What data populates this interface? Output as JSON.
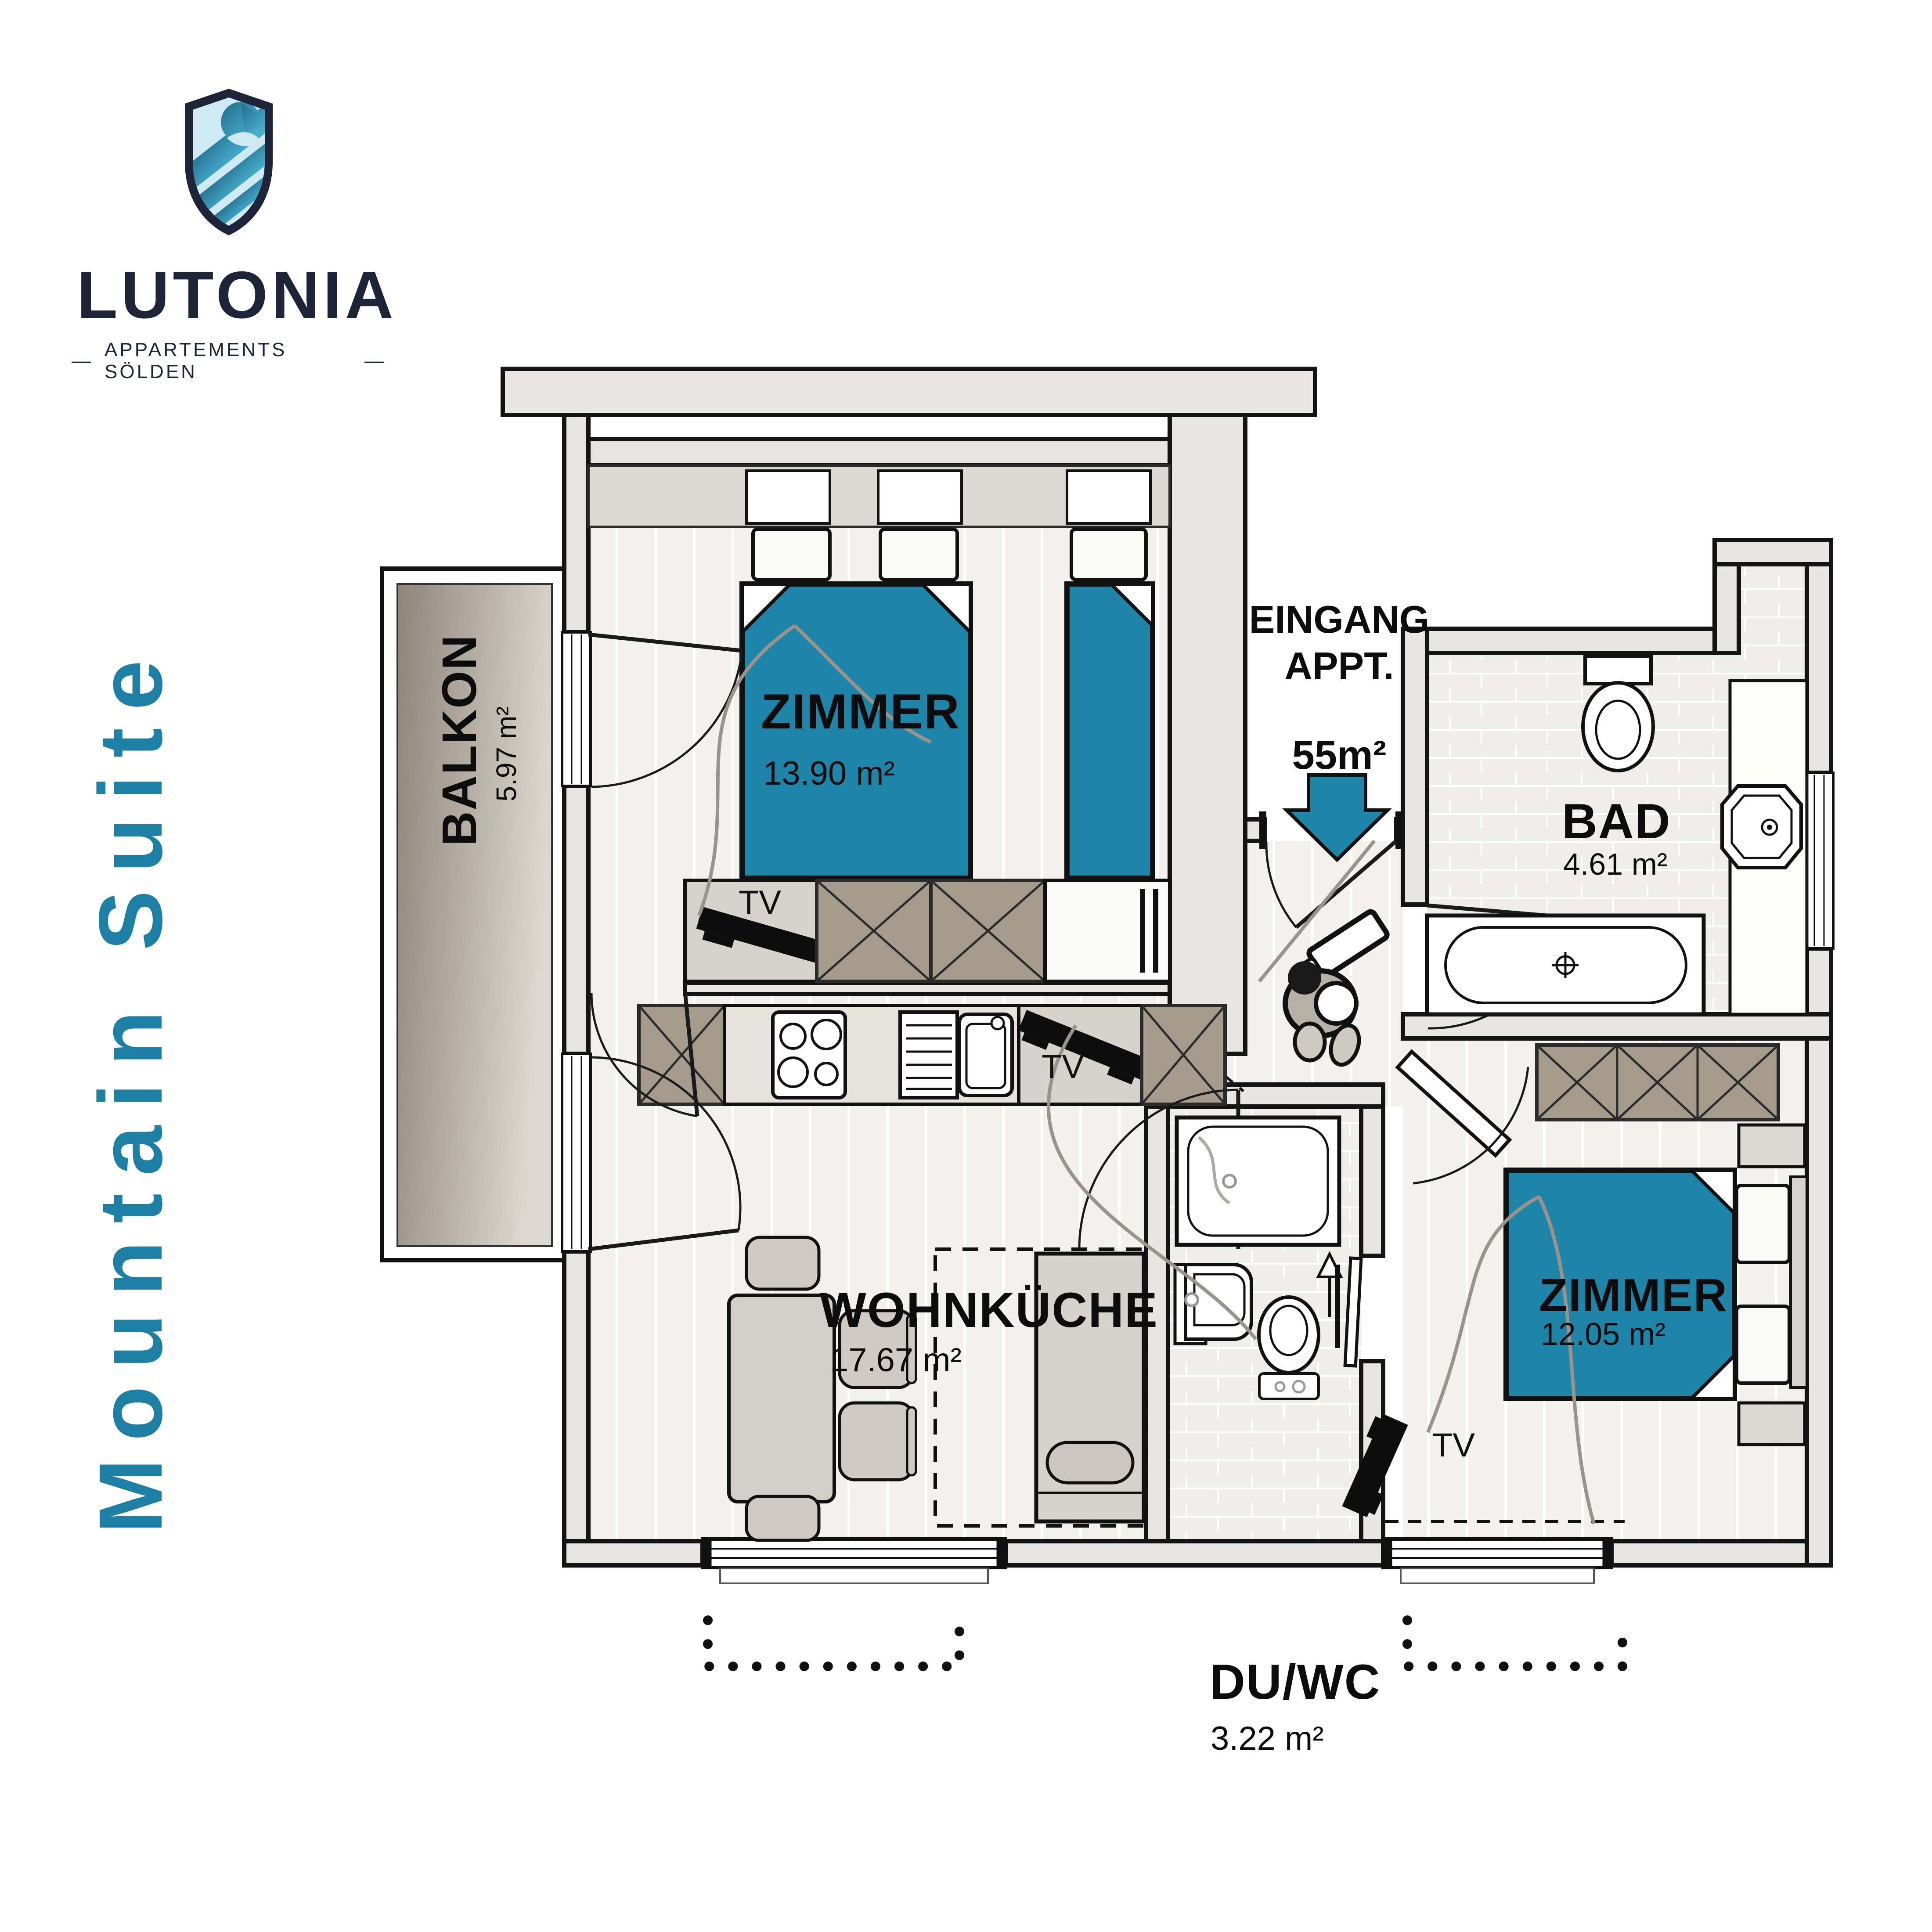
{
  "brand": {
    "shield_icon": "eagle-shield-icon",
    "name": "LUTONIA",
    "tagline": "APPARTEMENTS SÖLDEN",
    "tagline_dash": "—"
  },
  "suite_title": "Mountain Suite",
  "entrance": {
    "line1": "EINGANG",
    "line2": "APPT.",
    "total_area": "55m²"
  },
  "rooms": {
    "bedroom1": {
      "name": "ZIMMER",
      "area": "13.90 m²"
    },
    "bathroom": {
      "name": "BAD",
      "area": "4.61 m²"
    },
    "living": {
      "name": "WOHNKÜCHE",
      "area": "17.67 m²"
    },
    "bedroom2": {
      "name": "ZIMMER",
      "area": "12.05 m²"
    },
    "shower_wc": {
      "name": "DU/WC",
      "area": "3.22 m²"
    },
    "balcony": {
      "name": "BALKON",
      "area": "5.97 m²"
    }
  },
  "labels": {
    "tv": "TV"
  },
  "colors": {
    "accent_teal": "#1e84a8",
    "navy": "#1d2438",
    "suite_text_teal": "#1d7fa3",
    "wall_fill": "#e8e6e2",
    "wardrobe_brown": "#a59b8d"
  }
}
